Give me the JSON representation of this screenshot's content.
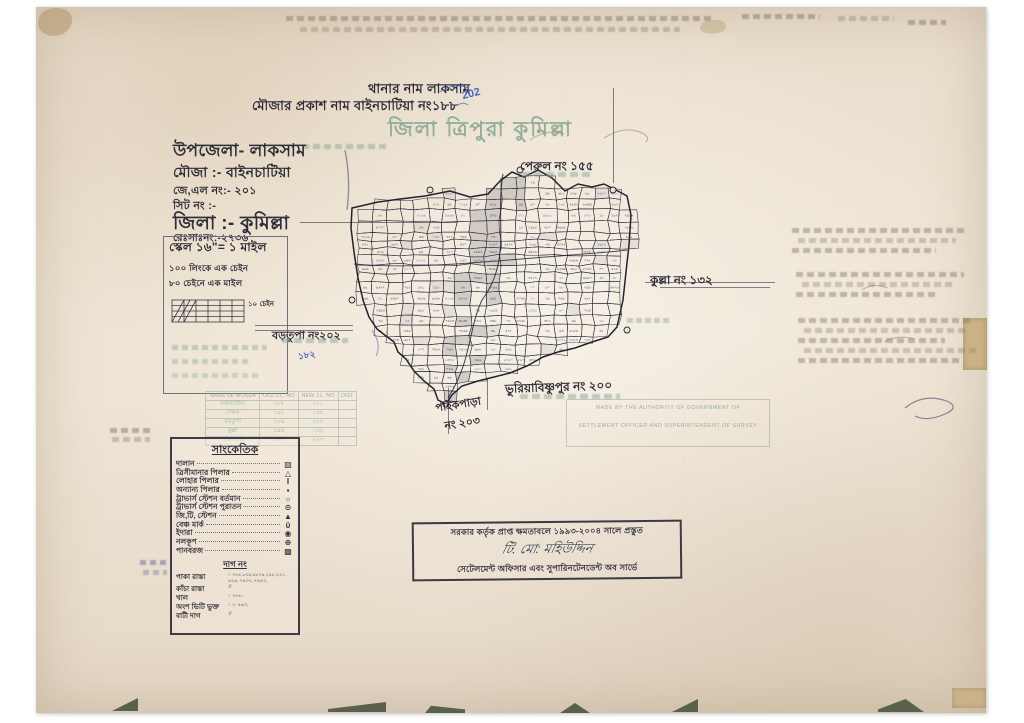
{
  "header": {
    "line1": "থানার নাম লাকসাম",
    "line2": "মৌজার প্রকাশ নাম বাইনচাটিয়া নং১৮৮",
    "blue_note": "202",
    "line3": "জিলা ত্রিপুরা কুমিল্লা"
  },
  "info": {
    "upazila": "উপজেলা- লাকসাম",
    "mouza": "মৌজা :- বাইনচাটিয়া",
    "jl_no": "জে,এল নং:- ২০১",
    "sheet_no": "সিট নং :-",
    "zila": "জিলা :- কুমিল্লা",
    "reg_no": "রেঃসাঃনং:-২৭৩৬"
  },
  "scale": {
    "line1": "স্কেল ১৬\"= ১ মাইল",
    "line2": "১০০ লিংকে এক চেইন",
    "line3": "৮০ চেইনে এক মাইল",
    "bar_label": "১০ চেইন"
  },
  "mouza_table": {
    "headers": [
      "NAME OF MOUZA",
      "OLD J.L. NO",
      "NEW J.L. NO",
      "DIST"
    ],
    "rows": [
      [
        "বাইনচাটিয়া",
        "১৮৮",
        "২০১",
        ""
      ],
      [
        "পেরুল",
        "১৬২",
        "১৫৫",
        ""
      ],
      [
        "বড়তুপা",
        "২০৬",
        "২০২",
        ""
      ],
      [
        "কুল্লা",
        "১৪৪",
        "১৩২",
        ""
      ],
      [
        "পাইকপাড়া",
        "১৬০",
        "২০৩",
        ""
      ]
    ]
  },
  "legend": {
    "title": "সাংকেতিক",
    "items": [
      {
        "label": "দালান",
        "symbol": "▨"
      },
      {
        "label": "ত্রিসীমানার পিলার",
        "symbol": "△"
      },
      {
        "label": "লোহার পিলার",
        "symbol": "I"
      },
      {
        "label": "অন্যান্য পিলার",
        "symbol": "▪"
      },
      {
        "label": "ট্রাভার্স স্টেশন বর্তমান",
        "symbol": "○"
      },
      {
        "label": "ট্রাভার্স স্টেশন পুরাতন",
        "symbol": "⊙"
      },
      {
        "label": "জি,টি, স্টেশন",
        "symbol": "▲"
      },
      {
        "label": "বেঞ্চ মার্ক",
        "symbol": "ϋ"
      },
      {
        "label": "ইদারা",
        "symbol": "◉"
      },
      {
        "label": "নলকূপ",
        "symbol": "⊕"
      },
      {
        "label": "পানবরজ",
        "symbol": "▩"
      }
    ],
    "dag_title": "দাগ নং",
    "dag_rows": [
      {
        "label": "পাকা রাস্তা",
        "value": ":- ৩৭৪,৮৩৯,৬৮৭৯,২৪৮,২৪১, ৬২৬, ৭৯৩৭, ৭৯৪৩,"
      },
      {
        "label": "কাঁচা রাস্তা",
        "value": "ঐ"
      },
      {
        "label": "খাল",
        "value": ":- ৩৭৪,-"
      },
      {
        "label": "অংশ ভিটি ভুক্ত",
        "value": ":- ২- ৪৬৩,"
      },
      {
        "label": "বাটী দাগ",
        "value": "ঐ"
      }
    ]
  },
  "neighbors": {
    "perul": "পেরুল নং ১৫৫",
    "kulla": "কুল্লা নং ১৩২",
    "bortupa": "বড়তুপা নং২০২",
    "bortupa_blue": "১৮২",
    "bhuriya": "ভুরিয়াবিষ্ণুপুর নং ২০০",
    "paikpara_1": "পাইকপাড়া",
    "paikpara_2": "নং ২০৩"
  },
  "stamp": {
    "line1": "সরকার কর্তৃক প্রাপ্ত ক্ষমতাবলে ১৯৯৩-২০০৪ সালে প্রস্তুত",
    "signature": "টি. মো: মহিউদ্দিন",
    "line3": "সেটেলমেন্ট অফিসার এবং সুপারিনটেনডেন্ট অব সার্ভে"
  },
  "ghost_stamp": {
    "line1": "MADE BY THE AUTHORITY OF GOVERNMENT OF",
    "line2": "SETTLEMENT OFFICER AND SUPERINTENDENT OF SURVEY"
  },
  "colors": {
    "paper": "#ece1d2",
    "ink": "#2e2d38",
    "green_stamp": "#8ba796",
    "blue_ink": "#4a63c8",
    "pencil": "#8e8472"
  }
}
